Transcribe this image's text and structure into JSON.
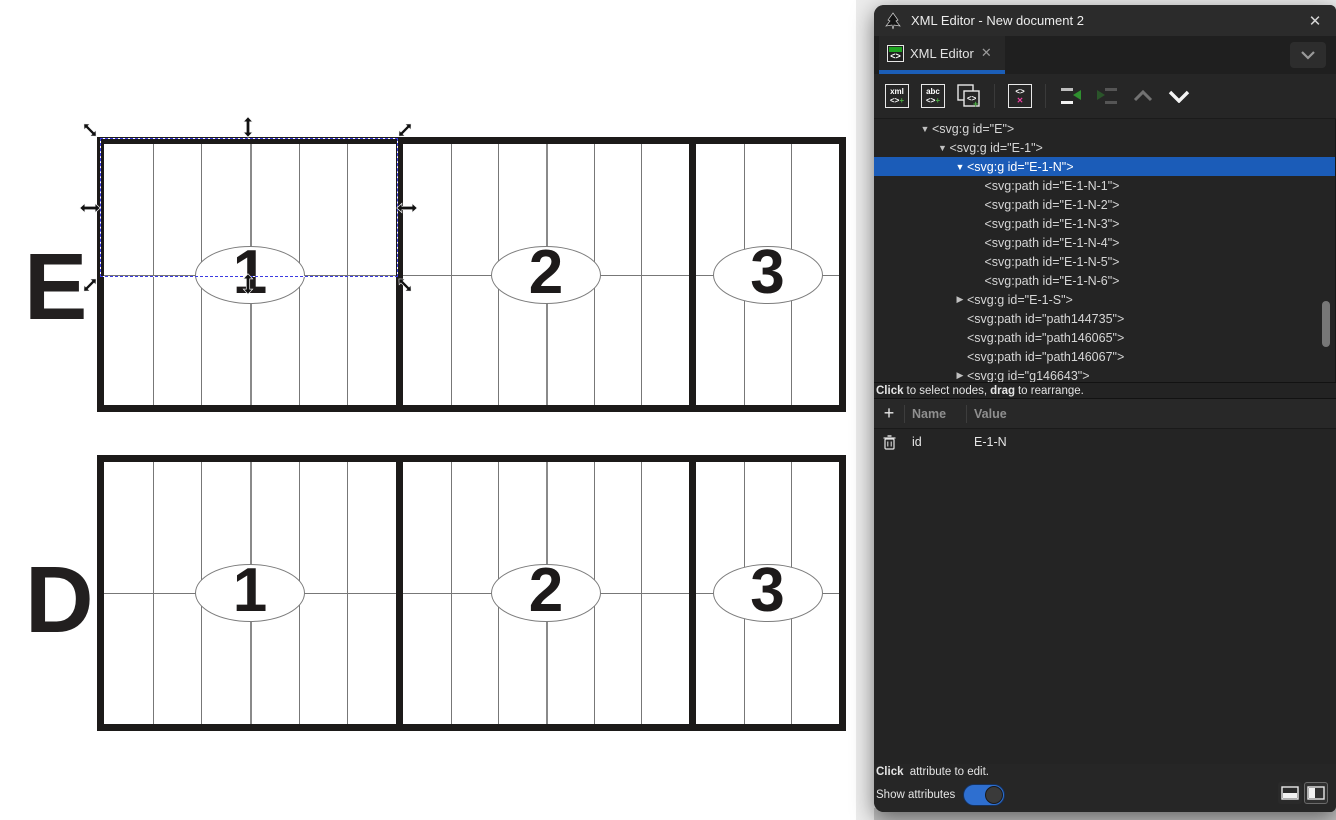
{
  "window": {
    "title": "XML Editor - New document 2",
    "close_glyph": "✕",
    "app_icon": "inkscape-logo-icon"
  },
  "tab": {
    "label": "XML Editor",
    "close_glyph": "✕",
    "icon": "xml-tag-icon"
  },
  "colors": {
    "accent_blue": "#1b5cb8",
    "toggle_blue": "#2e6fd0",
    "green": "#4cb043",
    "pink": "#ee3fa2",
    "panel_bg": "#262626"
  },
  "toolbar": {
    "glyph_xml": "xml",
    "glyph_abc": "abc",
    "glyph_tag": "<>",
    "glyph_plus": "+",
    "glyph_x": "✕",
    "buttons": [
      {
        "name": "new-element-node",
        "icon": "xml-plus-icon",
        "enabled": true
      },
      {
        "name": "new-text-node",
        "icon": "abc-plus-icon",
        "enabled": true
      },
      {
        "name": "duplicate-node",
        "icon": "duplicate-plus-icon",
        "enabled": true
      },
      {
        "name": "delete-node",
        "icon": "tag-x-icon",
        "enabled": true
      },
      {
        "name": "unindent-node",
        "icon": "unindent-icon",
        "enabled": true
      },
      {
        "name": "indent-node",
        "icon": "indent-icon",
        "enabled": false
      },
      {
        "name": "move-node-up",
        "icon": "chevron-up-icon",
        "enabled": false
      },
      {
        "name": "move-node-down",
        "icon": "chevron-down-icon",
        "enabled": true
      }
    ]
  },
  "tree": {
    "rows": [
      {
        "depth": 1,
        "expander": "expanded",
        "text": "<svg:g id=\"E\">",
        "selected": false
      },
      {
        "depth": 2,
        "expander": "expanded",
        "text": "<svg:g id=\"E-1\">",
        "selected": false
      },
      {
        "depth": 3,
        "expander": "expanded",
        "text": "<svg:g id=\"E-1-N\">",
        "selected": true
      },
      {
        "depth": 4,
        "expander": "none",
        "text": "<svg:path id=\"E-1-N-1\">",
        "selected": false
      },
      {
        "depth": 4,
        "expander": "none",
        "text": "<svg:path id=\"E-1-N-2\">",
        "selected": false
      },
      {
        "depth": 4,
        "expander": "none",
        "text": "<svg:path id=\"E-1-N-3\">",
        "selected": false
      },
      {
        "depth": 4,
        "expander": "none",
        "text": "<svg:path id=\"E-1-N-4\">",
        "selected": false
      },
      {
        "depth": 4,
        "expander": "none",
        "text": "<svg:path id=\"E-1-N-5\">",
        "selected": false
      },
      {
        "depth": 4,
        "expander": "none",
        "text": "<svg:path id=\"E-1-N-6\">",
        "selected": false
      },
      {
        "depth": 3,
        "expander": "collapsed",
        "text": "<svg:g id=\"E-1-S\">",
        "selected": false
      },
      {
        "depth": 3,
        "expander": "none",
        "text": "<svg:path id=\"path144735\">",
        "selected": false
      },
      {
        "depth": 3,
        "expander": "none",
        "text": "<svg:path id=\"path146065\">",
        "selected": false
      },
      {
        "depth": 3,
        "expander": "none",
        "text": "<svg:path id=\"path146067\">",
        "selected": false
      },
      {
        "depth": 3,
        "expander": "collapsed",
        "text": "<svg:g id=\"g146643\">",
        "selected": false
      }
    ]
  },
  "tree_hint": {
    "bold1": "Click",
    "text1": " to select nodes, ",
    "bold2": "drag",
    "text2": " to rearrange."
  },
  "attributes": {
    "add_glyph": "+",
    "headers": {
      "name": "Name",
      "value": "Value"
    },
    "rows": [
      {
        "name": "id",
        "value": "E-1-N"
      }
    ]
  },
  "attr_hint": {
    "bold1": "Click",
    "text1": " attribute to edit."
  },
  "show_attributes": {
    "label": "Show attributes",
    "state": "on"
  },
  "canvas": {
    "boards": [
      {
        "label": "E",
        "sections": [
          {
            "number": "1",
            "columns": 6
          },
          {
            "number": "2",
            "columns": 6
          },
          {
            "number": "3",
            "columns": 3
          }
        ]
      },
      {
        "label": "D",
        "sections": [
          {
            "number": "1",
            "columns": 6
          },
          {
            "number": "2",
            "columns": 6
          },
          {
            "number": "3",
            "columns": 3
          }
        ]
      }
    ],
    "selection_note": "selection handles around top half of board E section 1"
  }
}
